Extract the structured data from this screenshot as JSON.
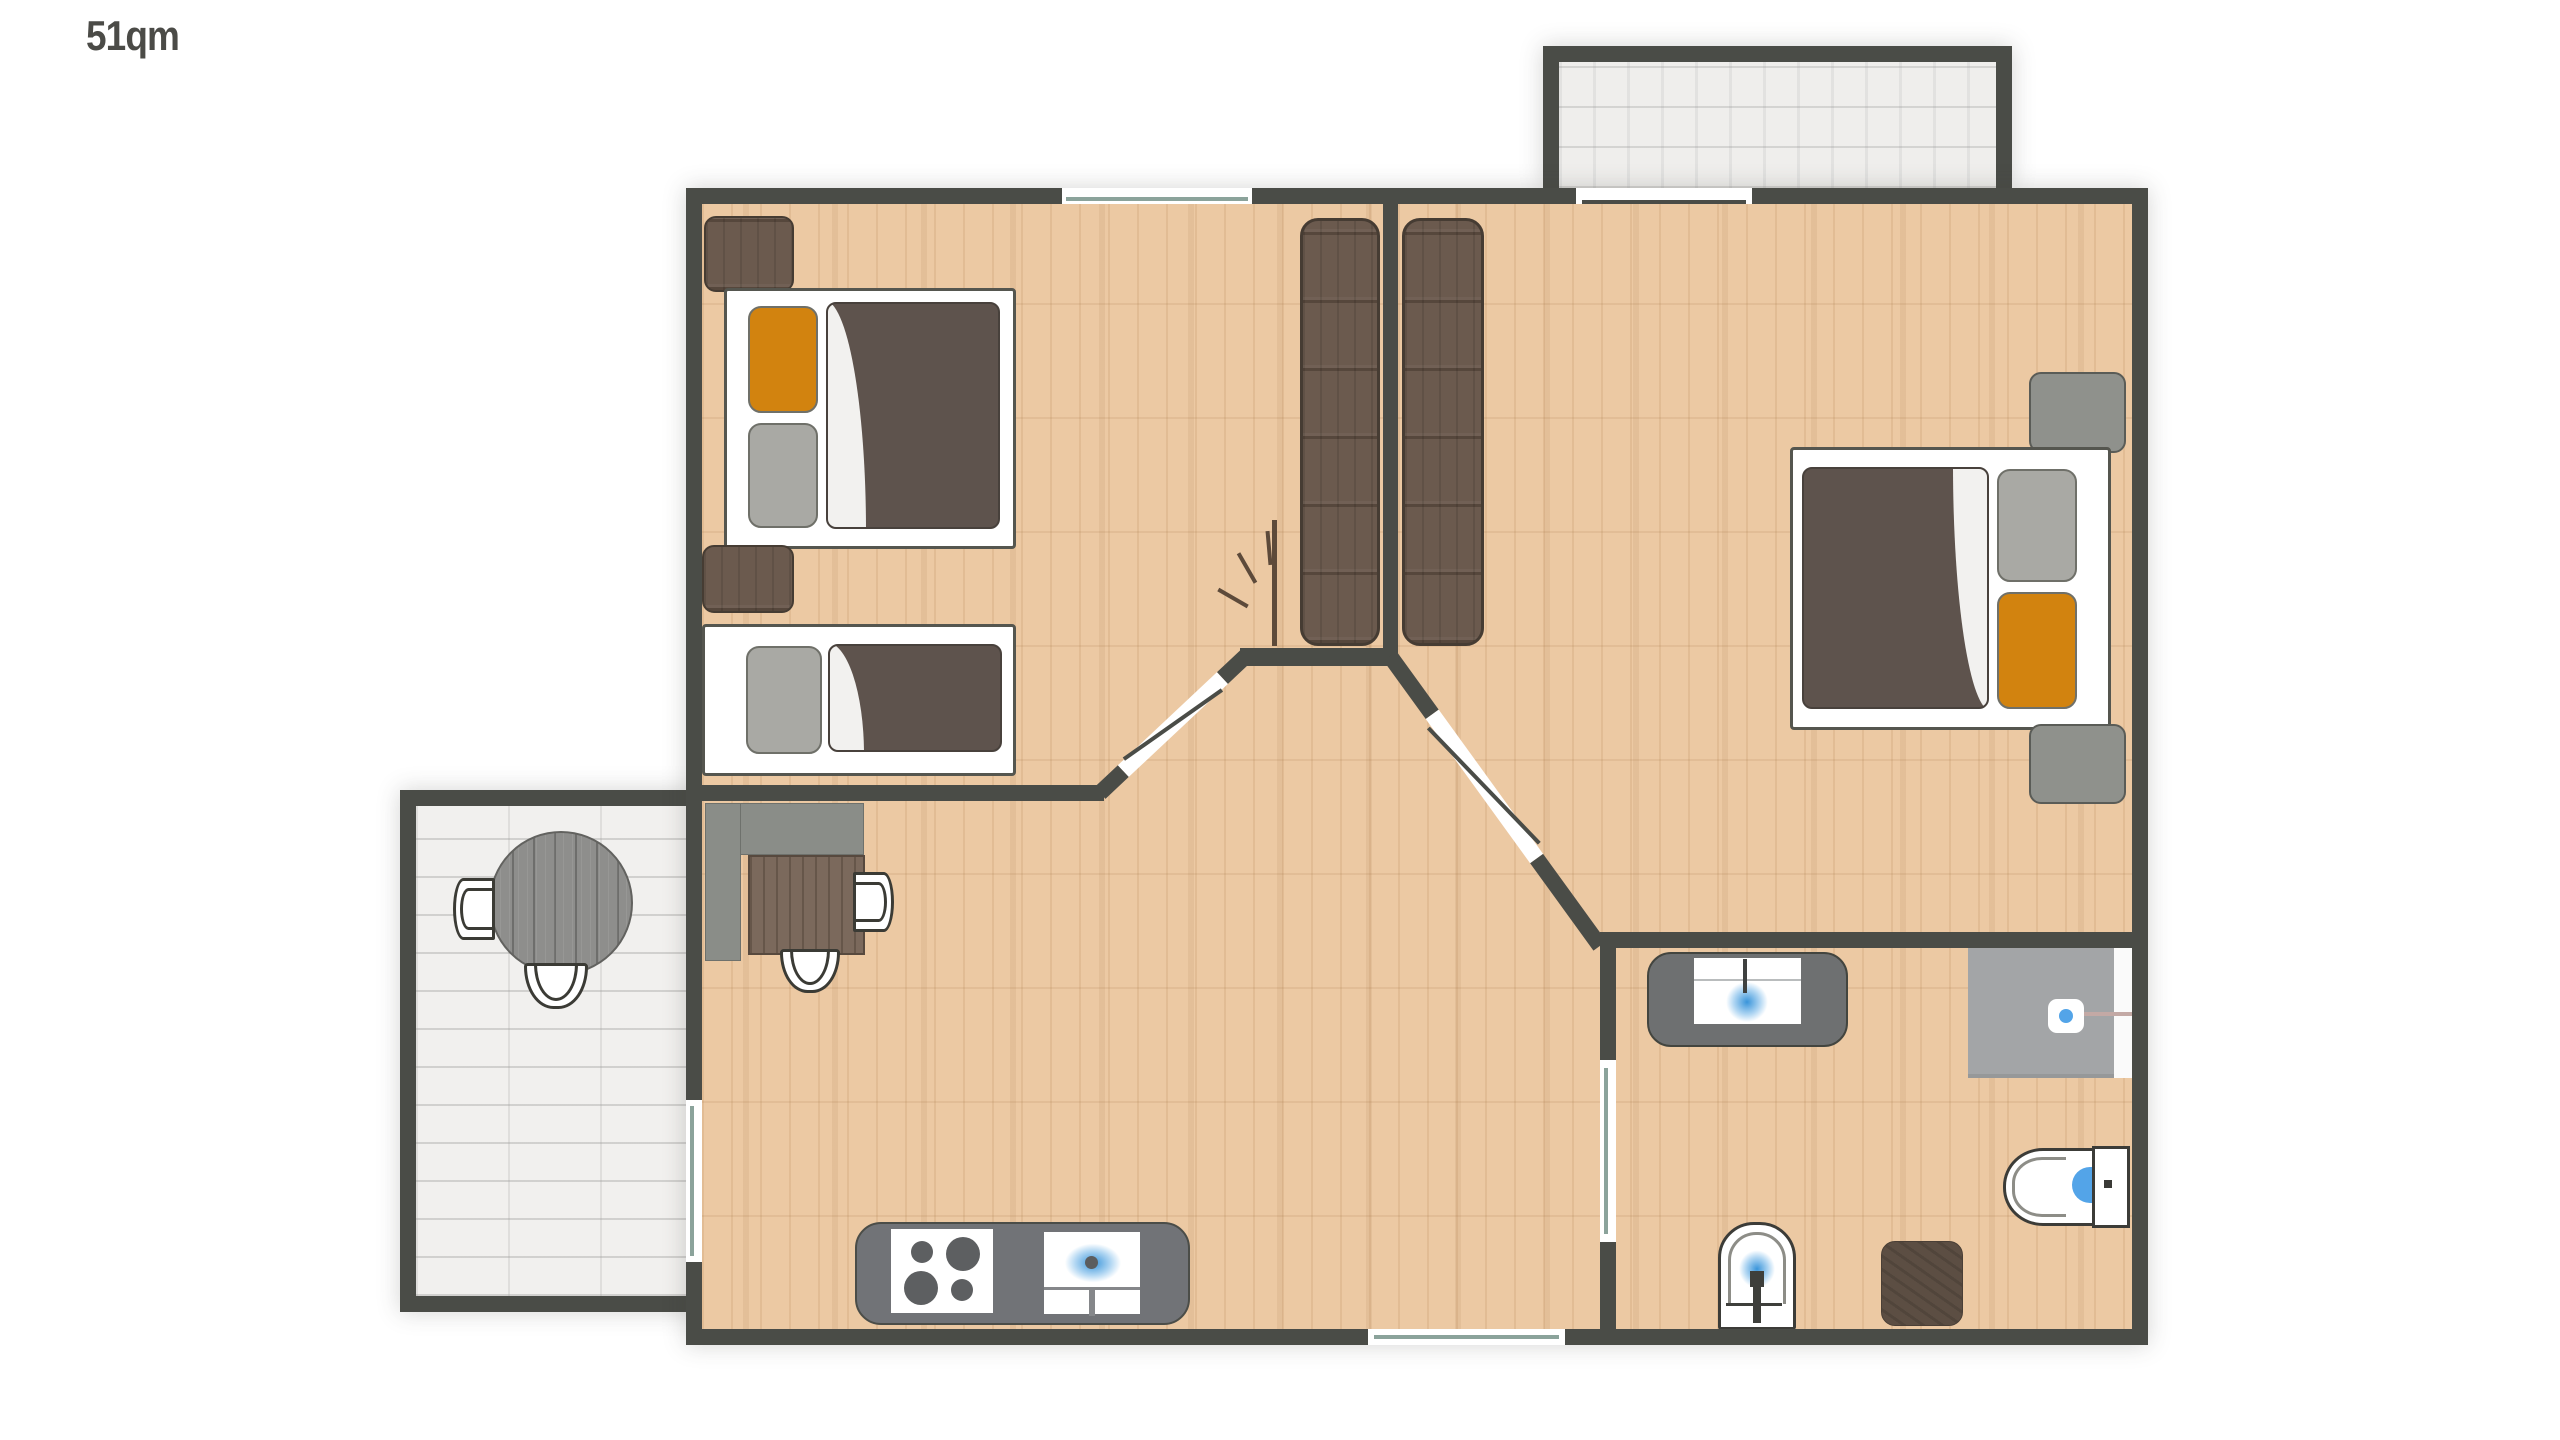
{
  "plan": {
    "area_label": "51qm"
  },
  "colors": {
    "wall": "#4a4c47",
    "floor-wood": "#ecc9a3",
    "tile": "#efeeec",
    "blanket": "#5e534d",
    "pillow-gray": "#a9a9a4",
    "pillow-orange": "#d2830f",
    "wood-dark": "#6b5a4e",
    "wood-mid": "#7b695c",
    "gray-furniture": "#8a8d88",
    "counter-gray": "#717377",
    "shower-gray": "#a3a5a7",
    "water-blue": "#53a4e8",
    "outline-dark": "#3c3c38",
    "window-line": "#8ba39b",
    "label": "#4b4b47"
  },
  "symbols": [
    "double-bed",
    "single-bed",
    "nightstand",
    "wardrobe",
    "door-swing-marks",
    "desk",
    "desk-chair",
    "round-table",
    "terrace-chair",
    "kitchen-counter",
    "stove",
    "kitchen-sink",
    "bathroom-vanity",
    "shower",
    "toilet",
    "wash-basin",
    "bath-mat",
    "window",
    "sliding-door",
    "hinged-door",
    "entrance-door"
  ]
}
